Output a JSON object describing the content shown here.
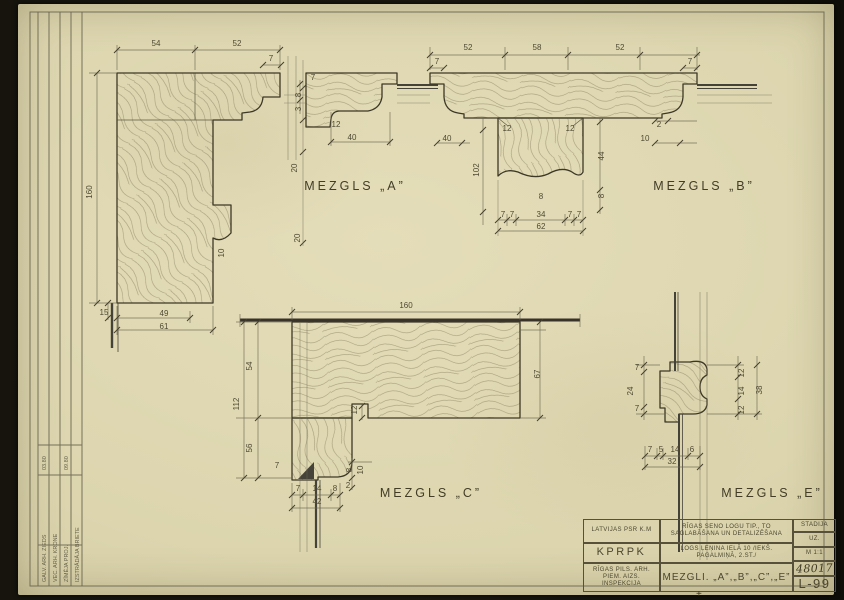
{
  "colors": {
    "paper": "#dcd5ae",
    "photo_background": "#16140d",
    "ink": "#3d3826",
    "dimension": "#4f4933",
    "glass": "#45423a",
    "grain": "#8b8161"
  },
  "details": [
    {
      "id": "mezgls-a",
      "label": "MEZGLS „A”",
      "label_x": 355,
      "label_y": 190,
      "dims": [
        {
          "x": 156,
          "y": 46,
          "t": "54"
        },
        {
          "x": 237,
          "y": 46,
          "t": "52"
        },
        {
          "x": 271,
          "y": 61,
          "t": "7"
        },
        {
          "x": 92,
          "y": 192,
          "t": "160",
          "r": 1
        },
        {
          "x": 313,
          "y": 80,
          "t": "7"
        },
        {
          "x": 301,
          "y": 95,
          "t": "8",
          "r": 1
        },
        {
          "x": 301,
          "y": 109,
          "t": "3",
          "r": 1
        },
        {
          "x": 336,
          "y": 127,
          "t": "12"
        },
        {
          "x": 352,
          "y": 140,
          "t": "40"
        },
        {
          "x": 297,
          "y": 168,
          "t": "20",
          "r": 1
        },
        {
          "x": 300,
          "y": 238,
          "t": "20",
          "r": 1
        },
        {
          "x": 224,
          "y": 253,
          "t": "10",
          "r": 1
        },
        {
          "x": 104,
          "y": 315,
          "t": "15"
        },
        {
          "x": 164,
          "y": 316,
          "t": "49"
        },
        {
          "x": 164,
          "y": 329,
          "t": "61"
        }
      ]
    },
    {
      "id": "mezgls-b",
      "label": "MEZGLS „B”",
      "label_x": 704,
      "label_y": 190,
      "dims": [
        {
          "x": 468,
          "y": 50,
          "t": "52"
        },
        {
          "x": 537,
          "y": 50,
          "t": "58"
        },
        {
          "x": 620,
          "y": 50,
          "t": "52"
        },
        {
          "x": 437,
          "y": 64,
          "t": "7"
        },
        {
          "x": 690,
          "y": 64,
          "t": "7"
        },
        {
          "x": 507,
          "y": 131,
          "t": "12"
        },
        {
          "x": 570,
          "y": 131,
          "t": "12"
        },
        {
          "x": 447,
          "y": 141,
          "t": "40"
        },
        {
          "x": 659,
          "y": 127,
          "t": "2"
        },
        {
          "x": 645,
          "y": 141,
          "t": "10"
        },
        {
          "x": 479,
          "y": 170,
          "t": "102",
          "r": 1
        },
        {
          "x": 604,
          "y": 156,
          "t": "44",
          "r": 1
        },
        {
          "x": 604,
          "y": 196,
          "t": "8",
          "r": 1
        },
        {
          "x": 541,
          "y": 199,
          "t": "8"
        },
        {
          "x": 503,
          "y": 217,
          "t": "7"
        },
        {
          "x": 512,
          "y": 217,
          "t": "7"
        },
        {
          "x": 541,
          "y": 217,
          "t": "34"
        },
        {
          "x": 570,
          "y": 217,
          "t": "7"
        },
        {
          "x": 579,
          "y": 217,
          "t": "7"
        },
        {
          "x": 541,
          "y": 229,
          "t": "62"
        }
      ]
    },
    {
      "id": "mezgls-c",
      "label": "MEZGLS „C”",
      "label_x": 431,
      "label_y": 497,
      "dims": [
        {
          "x": 406,
          "y": 308,
          "t": "160"
        },
        {
          "x": 252,
          "y": 366,
          "t": "54",
          "r": 1
        },
        {
          "x": 239,
          "y": 404,
          "t": "112",
          "r": 1
        },
        {
          "x": 252,
          "y": 448,
          "t": "56",
          "r": 1
        },
        {
          "x": 540,
          "y": 374,
          "t": "67",
          "r": 1
        },
        {
          "x": 357,
          "y": 410,
          "t": "12",
          "r": 1
        },
        {
          "x": 277,
          "y": 468,
          "t": "7"
        },
        {
          "x": 298,
          "y": 491,
          "t": "7"
        },
        {
          "x": 317,
          "y": 491,
          "t": "14"
        },
        {
          "x": 335,
          "y": 491,
          "t": "8"
        },
        {
          "x": 317,
          "y": 504,
          "t": "42"
        },
        {
          "x": 352,
          "y": 470,
          "t": "8",
          "r": 1
        },
        {
          "x": 363,
          "y": 470,
          "t": "10",
          "r": 1
        },
        {
          "x": 348,
          "y": 488,
          "t": "2"
        }
      ]
    },
    {
      "id": "mezgls-e",
      "label": "MEZGLS „E”",
      "label_x": 772,
      "label_y": 497,
      "dims": [
        {
          "x": 637,
          "y": 370,
          "t": "7"
        },
        {
          "x": 633,
          "y": 391,
          "t": "24",
          "r": 1
        },
        {
          "x": 637,
          "y": 411,
          "t": "7"
        },
        {
          "x": 744,
          "y": 373,
          "t": "12",
          "r": 1
        },
        {
          "x": 744,
          "y": 391,
          "t": "14",
          "r": 1
        },
        {
          "x": 744,
          "y": 410,
          "t": "12",
          "r": 1
        },
        {
          "x": 762,
          "y": 390,
          "t": "38",
          "r": 1
        },
        {
          "x": 650,
          "y": 452,
          "t": "7"
        },
        {
          "x": 661,
          "y": 452,
          "t": "5"
        },
        {
          "x": 675,
          "y": 452,
          "t": "14"
        },
        {
          "x": 692,
          "y": 452,
          "t": "6"
        },
        {
          "x": 672,
          "y": 464,
          "t": "32"
        }
      ]
    }
  ],
  "margin_table": {
    "rows": [
      {
        "label": "GALV. ARH.  ZIEDS",
        "date": "03.80"
      },
      {
        "label": "VEC. ARH.  KRONE",
        "date": ""
      },
      {
        "label": "ZĪMĒJA  PROJ.",
        "date": "09.80"
      },
      {
        "label": "IZSTRĀDĀJA  BRIETE",
        "date": ""
      }
    ],
    "row_x": [
      46,
      57,
      68,
      79
    ]
  },
  "stamp": {
    "org_top": "LATVIJAS PSR K.M",
    "org_main": "KPRPK",
    "org_sub": "RĪGAS PILS. ARH. PIEM. AIZS. INSPEKCIJA",
    "project": "RĪGAS SENO LOGU TIP., TO SAGLABĀŠANA UN DETALIZĒŠANA",
    "object": "LOGS ĻEŅINA IELĀ 10 /IEKŠ. PAGALMIŅĀ, 2.ST./",
    "sheet_title": "MEZGLI. „A”,„B”,„C”,„E”",
    "stage_label": "STADIJA",
    "stage_value": "UZ.",
    "scale": "M 1:1",
    "order_no": "48017",
    "sheet_no": "L-99",
    "mark": "+"
  }
}
